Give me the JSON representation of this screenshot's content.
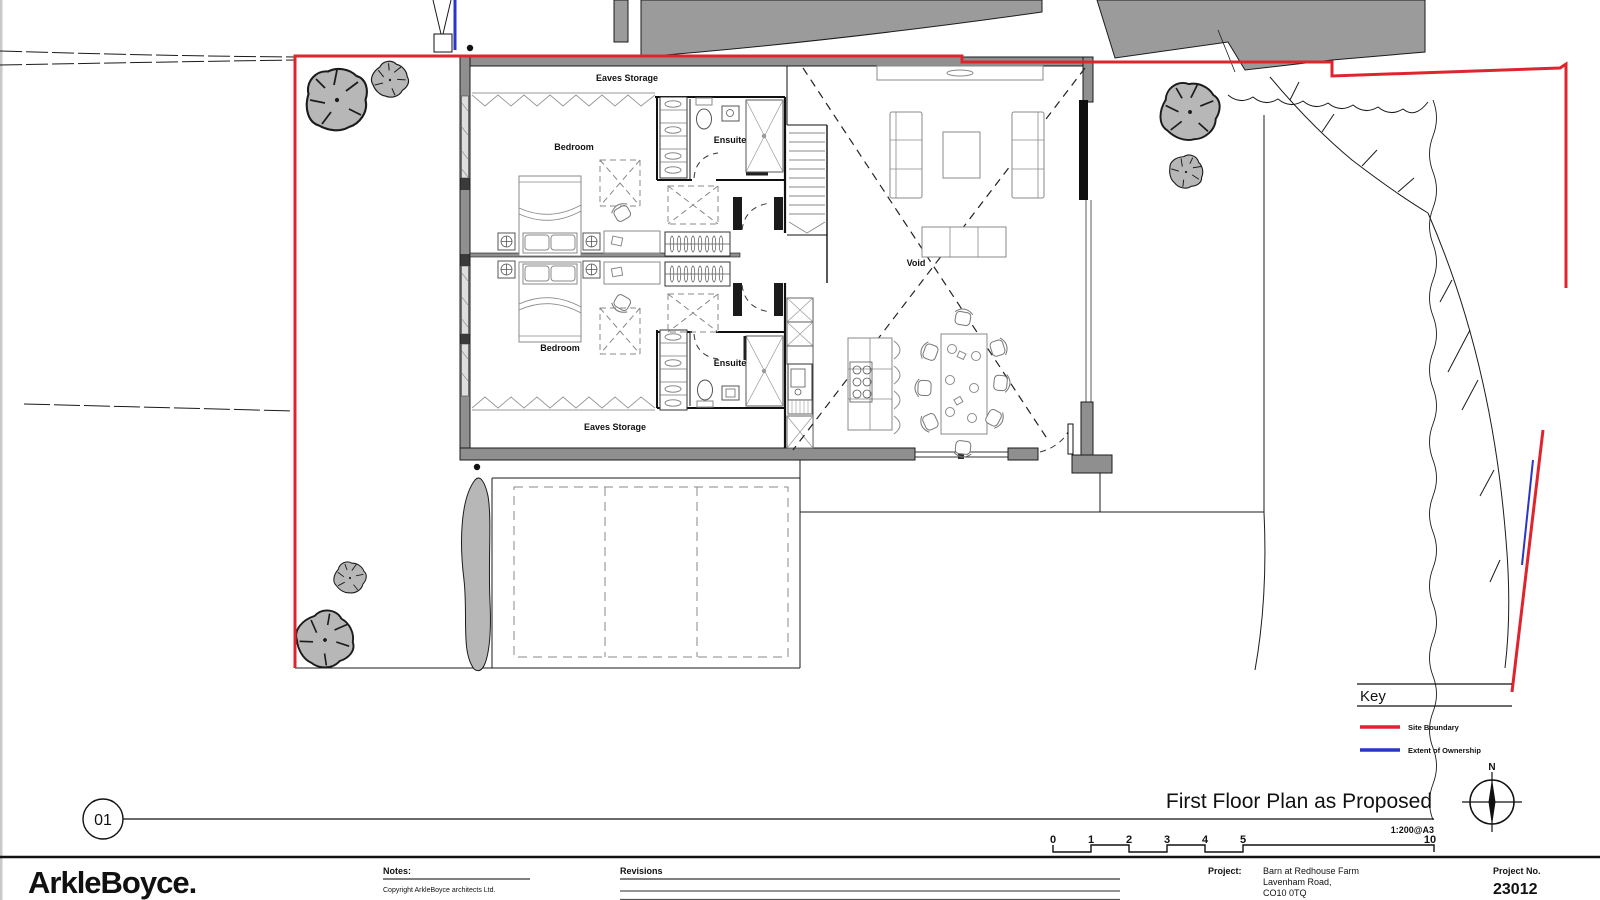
{
  "plan": {
    "labels": {
      "eaves_storage_top": "Eaves Storage",
      "eaves_storage_bottom": "Eaves Storage",
      "bedroom_top": "Bedroom",
      "bedroom_bottom": "Bedroom",
      "ensuite_top": "Ensuite",
      "ensuite_bottom": "Ensuite",
      "void": "Void"
    }
  },
  "key": {
    "title": "Key",
    "items": [
      {
        "label": "Site Boundary",
        "color": "#e0242e"
      },
      {
        "label": "Extent of Ownership",
        "color": "#2936c8"
      }
    ]
  },
  "title_bar": {
    "drawing_number": "01",
    "title": "First Floor Plan as Proposed",
    "scale": "1:200@A3",
    "scale_ticks": [
      "0",
      "1",
      "2",
      "3",
      "4",
      "5",
      "10"
    ],
    "north_label": "N"
  },
  "footer": {
    "logo": "ArkleBoyce.",
    "notes_label": "Notes:",
    "copyright": "Copyright ArkleBoyce architects Ltd.",
    "revisions_label": "Revisions",
    "project_label": "Project:",
    "project_name": "Barn at Redhouse Farm",
    "project_address_1": "Lavenham Road,",
    "project_address_2": "CO10 0TQ",
    "project_no_label": "Project No.",
    "project_no": "23012"
  },
  "colors": {
    "site_boundary": "#e0242e",
    "ownership": "#2936c8",
    "wall": "#8f8f8f",
    "tree": "#b7b7b7"
  }
}
